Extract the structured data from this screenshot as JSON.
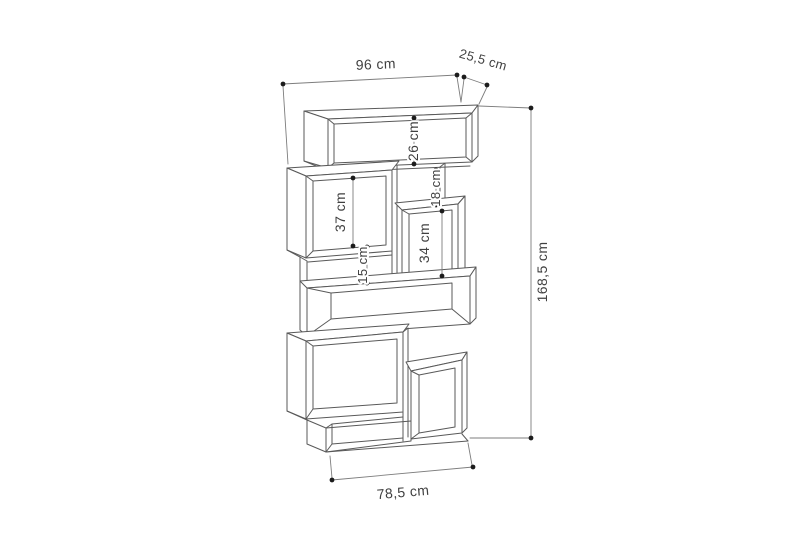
{
  "diagram": {
    "type": "furniture-dimension-drawing",
    "subject": "zigzag modular bookcase",
    "unit": "cm",
    "labels": {
      "width": "96 cm",
      "depth": "25,5 cm",
      "height": "168,5 cm",
      "base_width": "78,5 cm",
      "top_compartment": "26 cm",
      "left_compartment": "37 cm",
      "small_gap": "18 cm",
      "right_compartment": "34 cm",
      "middle_gap": "15 cm"
    },
    "values": {
      "width_cm": 96,
      "depth_cm": 25.5,
      "height_cm": 168.5,
      "base_width_cm": 78.5,
      "top_compartment_cm": 26,
      "left_compartment_cm": 37,
      "small_gap_cm": 18,
      "right_compartment_cm": 34,
      "middle_gap_cm": 15
    },
    "colors": {
      "background": "#ffffff",
      "wireframe_line": "#595959",
      "dimension_line": "#7d7d7d",
      "dimension_dot": "#1c1c1c",
      "label_text": "#404040"
    }
  }
}
